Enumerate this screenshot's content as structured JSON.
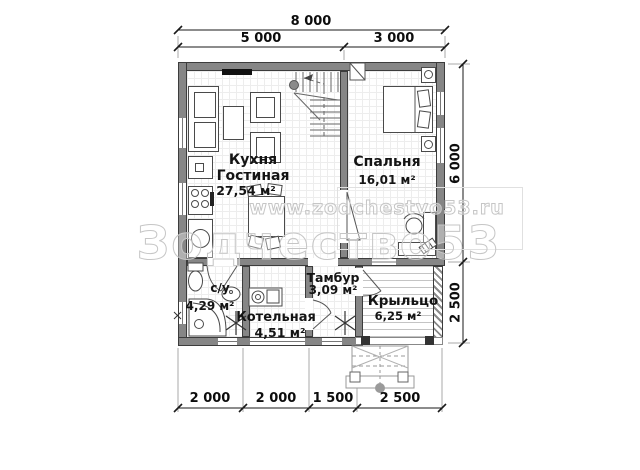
{
  "plan": {
    "dimensions": {
      "top_total": "8 000",
      "top_segments": [
        "5 000",
        "3 000"
      ],
      "right_segments": [
        "6 000",
        "2 500"
      ],
      "bottom_segments": [
        "2 000",
        "2 000",
        "1 500",
        "2 500"
      ]
    },
    "rooms": {
      "kitchen_living": {
        "name1": "Кухня",
        "name2": "Гостиная",
        "area": "27,54 м²"
      },
      "bedroom": {
        "name": "Спальня",
        "area": "16,01 м²"
      },
      "vestibule": {
        "name": "Тамбур",
        "area": "3,09 м²"
      },
      "bathroom": {
        "name": "с/у",
        "area": "4,29 м²"
      },
      "boiler": {
        "name": "Котельная",
        "area": "4,51 м²"
      },
      "porch": {
        "name": "Крыльцо",
        "area": "6,25 м²"
      }
    },
    "watermark": {
      "url": "www.zodchestvo53.ru",
      "brand": "Зодчество53"
    },
    "colors": {
      "wall": "#868686",
      "line": "#444444",
      "watermark_outline": "#c6c6c6",
      "dim_text": "#0d0d0d"
    }
  }
}
